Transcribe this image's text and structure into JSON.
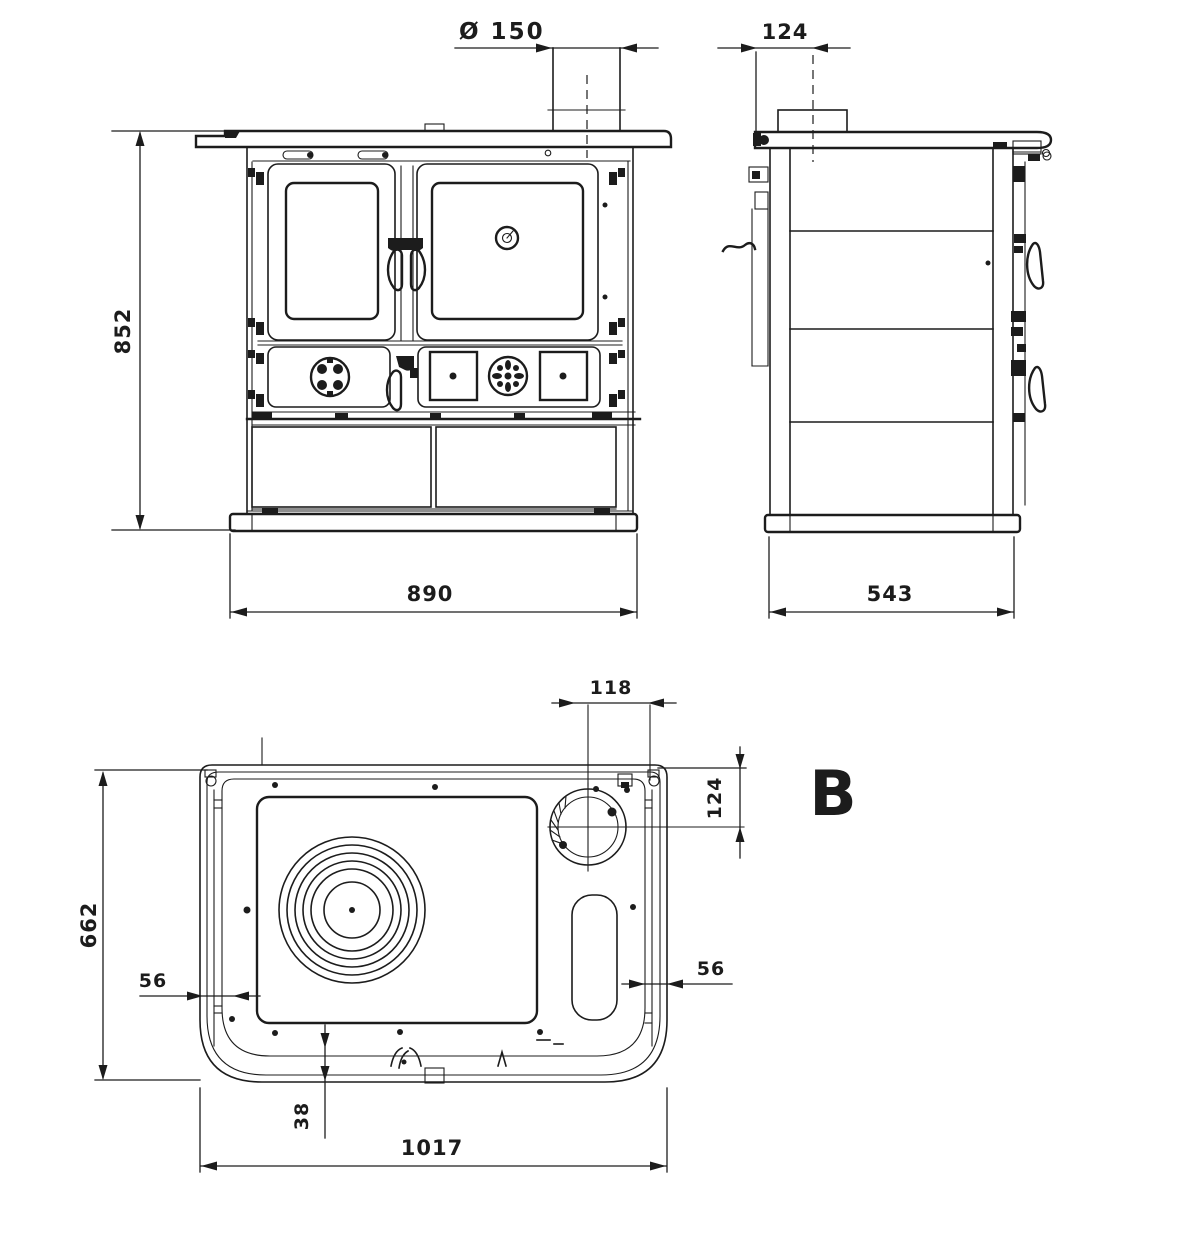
{
  "colors": {
    "ink": "#1c1c1c",
    "background": "#ffffff"
  },
  "front_view": {
    "height": "852",
    "width": "890",
    "flue_diameter": "Ø 150"
  },
  "side_view": {
    "flue_offset": "124",
    "depth": "543"
  },
  "top_view": {
    "section_label": "B",
    "flue_dim_x": "118",
    "flue_dim_y": "124",
    "depth": "662",
    "left_margin": "56",
    "right_margin": "56",
    "front_margin": "38",
    "width": "1017"
  }
}
